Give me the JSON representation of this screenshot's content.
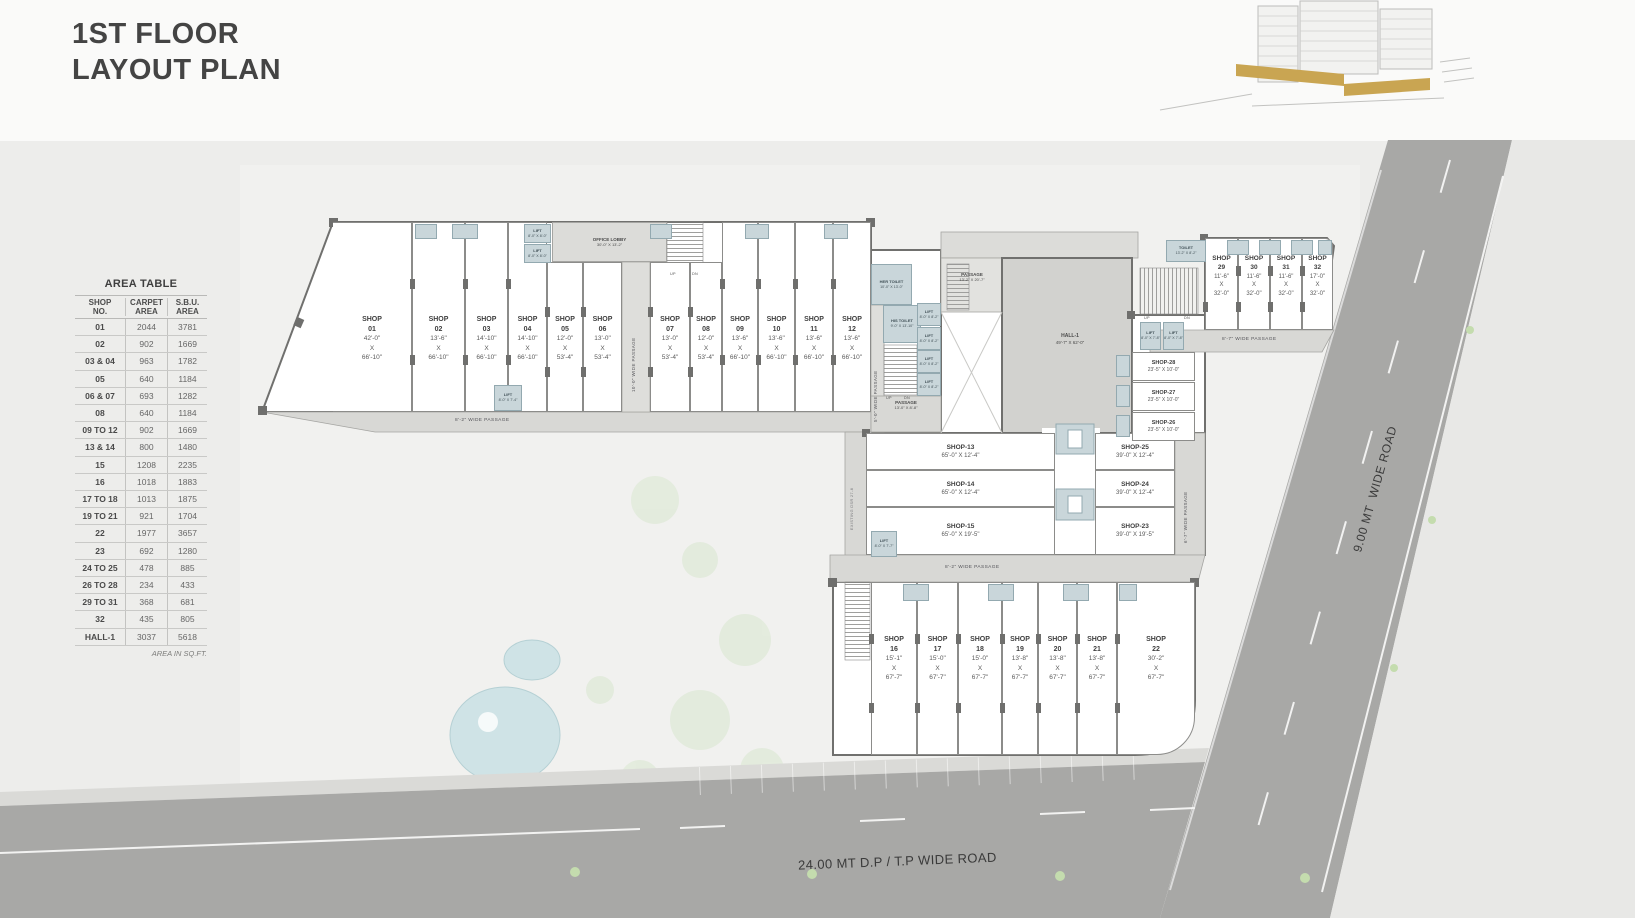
{
  "title": {
    "line1": "1ST FLOOR",
    "line2": "LAYOUT PLAN"
  },
  "area_table": {
    "title": "AREA TABLE",
    "columns": [
      "SHOP\nNO.",
      "CARPET\nAREA",
      "S.B.U.\nAREA"
    ],
    "rows": [
      {
        "no": "01",
        "carpet": "2044",
        "sbu": "3781"
      },
      {
        "no": "02",
        "carpet": "902",
        "sbu": "1669"
      },
      {
        "no": "03 & 04",
        "carpet": "963",
        "sbu": "1782"
      },
      {
        "no": "05",
        "carpet": "640",
        "sbu": "1184"
      },
      {
        "no": "06 & 07",
        "carpet": "693",
        "sbu": "1282"
      },
      {
        "no": "08",
        "carpet": "640",
        "sbu": "1184"
      },
      {
        "no": "09 TO 12",
        "carpet": "902",
        "sbu": "1669"
      },
      {
        "no": "13 & 14",
        "carpet": "800",
        "sbu": "1480"
      },
      {
        "no": "15",
        "carpet": "1208",
        "sbu": "2235"
      },
      {
        "no": "16",
        "carpet": "1018",
        "sbu": "1883"
      },
      {
        "no": "17 TO 18",
        "carpet": "1013",
        "sbu": "1875"
      },
      {
        "no": "19 TO 21",
        "carpet": "921",
        "sbu": "1704"
      },
      {
        "no": "22",
        "carpet": "1977",
        "sbu": "3657"
      },
      {
        "no": "23",
        "carpet": "692",
        "sbu": "1280"
      },
      {
        "no": "24 TO 25",
        "carpet": "478",
        "sbu": "885"
      },
      {
        "no": "26 TO 28",
        "carpet": "234",
        "sbu": "433"
      },
      {
        "no": "29 TO 31",
        "carpet": "368",
        "sbu": "681"
      },
      {
        "no": "32",
        "carpet": "435",
        "sbu": "805"
      },
      {
        "no": "HALL-1",
        "carpet": "3037",
        "sbu": "5618"
      }
    ],
    "footnote": "AREA IN SQ.FT."
  },
  "labels": {
    "shop_word": "SHOP",
    "x_word": "X",
    "hall_name": "HALL-1",
    "hall_dims": "49'-7\" X 62'-0\"",
    "office_lobby": "OFFICE LOBBY",
    "office_lobby_dims": "30'-0\" X 13'-2\"",
    "her_toilet": "HER TOILET",
    "her_toilet_dims": "10'-0\" X 13'-0\"",
    "his_toilet": "HIS TOILET",
    "his_toilet_dims": "9'-0\" X 13'-10\"",
    "toilet": "TOILET",
    "toilet_dims": "13'-2\" X 8'-2\"",
    "passage": "PASSAGE",
    "passage_a_dims": "13'-2\" X 20'-7\"",
    "passage_b_dims": "13'-0\" X 8'-8\"",
    "lift": "LIFT",
    "lift_a": "8'-0\" X 8'-0\"",
    "lift_b": "8'-0\" X 8'-2\"",
    "lift_c": "8'-0\" X 7'-8\"",
    "lift_d": "8'-0\" X 7'-7\"",
    "lift_e": "8'-0\" X 7'-4\"",
    "up": "UP",
    "dn": "DN",
    "wp10": "10'-0\" WIDE PASSAGE",
    "wp5": "5'-0\" WIDE PASSAGE",
    "wp82": "8'-2\" WIDE PASSAGE",
    "wp87": "8'-7\" WIDE PASSAGE",
    "wp67": "6'-7\" WIDE PASSAGE",
    "existing": "EXISTING DSR 27-8"
  },
  "shops": {
    "wing_a": [
      {
        "no": "01",
        "w": "42'-0\"",
        "h": "66'-10\""
      },
      {
        "no": "02",
        "w": "13'-6\"",
        "h": "66'-10\""
      },
      {
        "no": "03",
        "w": "14'-10\"",
        "h": "66'-10\""
      },
      {
        "no": "04",
        "w": "14'-10\"",
        "h": "66'-10\""
      },
      {
        "no": "05",
        "w": "12'-0\"",
        "h": "53'-4\""
      },
      {
        "no": "06",
        "w": "13'-0\"",
        "h": "53'-4\""
      },
      {
        "no": "07",
        "w": "13'-0\"",
        "h": "53'-4\""
      },
      {
        "no": "08",
        "w": "12'-0\"",
        "h": "53'-4\""
      },
      {
        "no": "09",
        "w": "13'-6\"",
        "h": "66'-10\""
      },
      {
        "no": "10",
        "w": "13'-6\"",
        "h": "66'-10\""
      },
      {
        "no": "11",
        "w": "13'-6\"",
        "h": "66'-10\""
      },
      {
        "no": "12",
        "w": "13'-6\"",
        "h": "66'-10\""
      }
    ],
    "right_wing": [
      {
        "no": "29",
        "w": "11'-6\"",
        "h": "32'-0\""
      },
      {
        "no": "30",
        "w": "11'-6\"",
        "h": "32'-0\""
      },
      {
        "no": "31",
        "w": "11'-6\"",
        "h": "32'-0\""
      },
      {
        "no": "32",
        "w": "17'-0\"",
        "h": "32'-0\""
      }
    ],
    "bottom_wing": [
      {
        "no": "16",
        "w": "15'-1\"",
        "h": "67'-7\""
      },
      {
        "no": "17",
        "w": "15'-0\"",
        "h": "67'-7\""
      },
      {
        "no": "18",
        "w": "15'-0\"",
        "h": "67'-7\""
      },
      {
        "no": "19",
        "w": "13'-8\"",
        "h": "67'-7\""
      },
      {
        "no": "20",
        "w": "13'-8\"",
        "h": "67'-7\""
      },
      {
        "no": "21",
        "w": "13'-8\"",
        "h": "67'-7\""
      },
      {
        "no": "22",
        "w": "30'-2\"",
        "h": "67'-7\""
      }
    ],
    "mid_left": [
      {
        "label": "SHOP-13",
        "dims": "65'-0\" X 12'-4\""
      },
      {
        "label": "SHOP-14",
        "dims": "65'-0\" X 12'-4\""
      },
      {
        "label": "SHOP-15",
        "dims": "65'-0\" X 19'-5\""
      }
    ],
    "mid_right": [
      {
        "label": "SHOP-25",
        "dims": "39'-0\" X 12'-4\""
      },
      {
        "label": "SHOP-24",
        "dims": "39'-0\" X 12'-4\""
      },
      {
        "label": "SHOP-23",
        "dims": "39'-0\" X 19'-5\""
      }
    ],
    "stack": [
      {
        "label": "SHOP-28",
        "dims": "23'-5\" X 10'-0\""
      },
      {
        "label": "SHOP-27",
        "dims": "23'-5\" X 10'-0\""
      },
      {
        "label": "SHOP-26",
        "dims": "23'-5\" X 10'-0\""
      }
    ]
  },
  "roads": {
    "bottom": "24.00 MT D.P / T.P WIDE ROAD",
    "right": "9.00 MT  WIDE ROAD"
  },
  "colors": {
    "accent_gold": "#c9a552",
    "road": "#a8a8a6",
    "service_blue": "#c9d6da"
  }
}
